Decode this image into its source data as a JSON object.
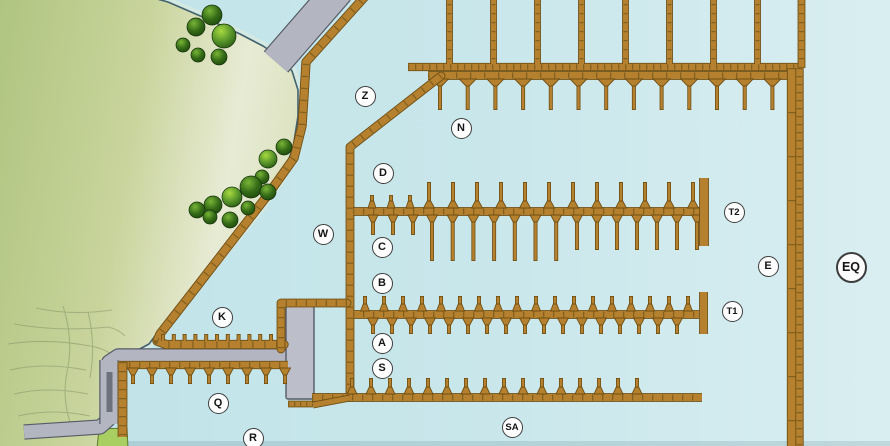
{
  "map_title": "Marina dock map",
  "colors": {
    "water_left": "#bfe3e8",
    "water_mid": "#c9e7eb",
    "water_right": "#d9eef1",
    "water_bottom_shade": "rgba(70,115,125,0.18)",
    "land_deep": "#aec47f",
    "land_mid": "#c9d49c",
    "land_pale": "#e8ebd4",
    "land_shore": "#dde3c2",
    "land_edge": "#41626e",
    "shallow_halo": "#d5e9e3",
    "sketch_line": "#7f9163",
    "lawn_fill": "#a9cf63",
    "lawn_edge": "#5c7a2e",
    "dock_fill": "#b5812f",
    "dock_edge": "#6f4e13",
    "dock_tick": "#7c5c1c",
    "road_fill": "#b3b6c1",
    "road_edge": "#565b66",
    "platform_fill": "#bcbfca",
    "ramp_dark": "#6d717c",
    "tree_hi": "#79b437",
    "tree_mid": "#356b17",
    "tree_dark": "#1c460c",
    "tree_bright_hi": "#a8d93f",
    "tree_bright_mid": "#57942a",
    "tree_bright_dark": "#245410",
    "label_bg": "#fdfdfd",
    "label_border": "#3d3d3d",
    "label_text": "#151515"
  },
  "labels": [
    {
      "id": "Z",
      "x": 365,
      "y": 96
    },
    {
      "id": "N",
      "x": 461,
      "y": 128
    },
    {
      "id": "D",
      "x": 383,
      "y": 173
    },
    {
      "id": "T2",
      "x": 734,
      "y": 212
    },
    {
      "id": "W",
      "x": 323,
      "y": 234
    },
    {
      "id": "C",
      "x": 382,
      "y": 247
    },
    {
      "id": "E",
      "x": 768,
      "y": 266
    },
    {
      "id": "EQ",
      "x": 851,
      "y": 267,
      "big": true
    },
    {
      "id": "B",
      "x": 382,
      "y": 283
    },
    {
      "id": "T1",
      "x": 732,
      "y": 311
    },
    {
      "id": "K",
      "x": 222,
      "y": 317
    },
    {
      "id": "A",
      "x": 382,
      "y": 343
    },
    {
      "id": "S",
      "x": 382,
      "y": 368
    },
    {
      "id": "Q",
      "x": 218,
      "y": 403
    },
    {
      "id": "SA",
      "x": 512,
      "y": 427
    },
    {
      "id": "R",
      "x": 253,
      "y": 438
    }
  ],
  "land": {
    "outline": [
      [
        -8,
        -8
      ],
      [
        132,
        -8
      ],
      [
        168,
        2
      ],
      [
        205,
        18
      ],
      [
        240,
        34
      ],
      [
        263,
        46
      ],
      [
        281,
        58
      ],
      [
        292,
        71
      ],
      [
        298,
        90
      ],
      [
        298,
        116
      ],
      [
        293,
        148
      ],
      [
        281,
        179
      ],
      [
        262,
        206
      ],
      [
        238,
        236
      ],
      [
        208,
        272
      ],
      [
        180,
        306
      ],
      [
        158,
        332
      ],
      [
        149,
        344
      ],
      [
        136,
        351
      ],
      [
        119,
        356
      ],
      [
        112,
        363
      ],
      [
        110,
        400
      ],
      [
        107,
        420
      ],
      [
        100,
        428
      ],
      [
        103,
        448
      ],
      [
        -8,
        448
      ]
    ],
    "sketch_paths": [
      "M36,308 Q72,316 112,310",
      "M14,324 Q58,332 108,327 Q118,329 125,336",
      "M8,344 Q48,338 90,346 Q103,348 111,354",
      "M10,370 Q44,362 86,370",
      "M14,394 Q48,386 88,394",
      "M18,416 Q52,408 90,416",
      "M63,306 Q74,340 67,372 Q62,398 70,422",
      "M88,312 Q96,344 90,378"
    ],
    "lawn": [
      [
        99,
        429
      ],
      [
        127,
        428
      ],
      [
        128,
        448
      ],
      [
        97,
        448
      ]
    ]
  },
  "roads": [
    {
      "name": "access-bridge",
      "path": [
        [
          338.5,
          -10
        ],
        [
          276,
          62
        ]
      ],
      "w": 30
    },
    {
      "name": "shore-road",
      "path": [
        [
          24,
          432
        ],
        [
          100,
          427
        ],
        [
          108,
          420
        ],
        [
          109,
          362
        ],
        [
          118,
          356
        ],
        [
          286,
          356
        ]
      ],
      "w": 13
    },
    {
      "name": "ramp-road",
      "path": [
        [
          109,
          360
        ],
        [
          109,
          424
        ]
      ],
      "w": 17
    }
  ],
  "ramp_rect": {
    "x": 106.5,
    "y": 372,
    "w": 6,
    "h": 40
  },
  "platform": {
    "x": 286,
    "y": 306,
    "w": 28,
    "h": 93
  },
  "docks": [
    {
      "name": "shore-boardwalk",
      "path": [
        [
          369,
          -8
        ],
        [
          306,
          62
        ],
        [
          304,
          96
        ],
        [
          302,
          126
        ],
        [
          294,
          158
        ],
        [
          267,
          196
        ],
        [
          229,
          245
        ],
        [
          195,
          289
        ],
        [
          160,
          334
        ],
        [
          157,
          341
        ],
        [
          166,
          344.5
        ],
        [
          284,
          344.5
        ]
      ],
      "w": 7.5,
      "tick": 12,
      "join": "round",
      "fingers": [
        {
          "dir": -1,
          "x0": 163,
          "dx": 10.8,
          "n": 12,
          "from": 341,
          "len": 7,
          "base": 0
        }
      ]
    },
    {
      "name": "top-walkway",
      "path": [
        [
          408,
          67
        ],
        [
          802,
          67
        ]
      ],
      "w": 6.5,
      "tick": 7
    },
    {
      "name": "mooring-piers",
      "path": [
        [
          449.5,
          -5
        ],
        [
          449.5,
          64
        ]
      ],
      "w": 5,
      "tick": 9,
      "repeat": {
        "dx": 44,
        "n": 8
      }
    },
    {
      "name": "breakwater-pier-top",
      "path": [
        [
          801.5,
          -5
        ],
        [
          801.5,
          68
        ]
      ],
      "w": 6,
      "tick": 9
    },
    {
      "name": "n-dock",
      "path": [
        [
          428,
          75.5
        ],
        [
          793,
          75.5
        ]
      ],
      "w": 7,
      "tick": 14,
      "fingers": [
        {
          "dir": 1,
          "x0": 440,
          "dx": 27.7,
          "n": 13,
          "from": 79,
          "len": 31,
          "base": 17
        }
      ]
    },
    {
      "name": "main-dock",
      "path": [
        [
          441,
          76
        ],
        [
          350,
          147
        ],
        [
          350,
          397
        ]
      ],
      "w": 7,
      "tick": 11,
      "join": "round"
    },
    {
      "name": "cd-dock",
      "path": [
        [
          353,
          211.5
        ],
        [
          700,
          211.5
        ]
      ],
      "w": 7,
      "tick": 10,
      "fingers": [
        {
          "dir": -1,
          "xs": [
            372,
            391,
            410
          ],
          "from": 208,
          "len": 13,
          "base": 8
        },
        {
          "dir": -1,
          "x0": 429,
          "dx": 24,
          "n": 12,
          "from": 208,
          "len": 26,
          "base": 11
        },
        {
          "dir": 1,
          "x0": 373,
          "dx": 20,
          "n": 3,
          "from": 215,
          "len": 20,
          "base": 10
        },
        {
          "dir": 1,
          "x0": 432,
          "dx": 20.7,
          "n": 7,
          "from": 215,
          "len": 46,
          "base": 11
        },
        {
          "dir": 1,
          "x0": 577,
          "dx": 20,
          "n": 7,
          "from": 215,
          "len": 35,
          "base": 11
        }
      ]
    },
    {
      "name": "t2-cap",
      "path": [
        [
          704,
          178
        ],
        [
          704,
          246
        ]
      ],
      "w": 8,
      "tick": 0
    },
    {
      "name": "ab-dock",
      "path": [
        [
          353,
          314.5
        ],
        [
          699,
          314.5
        ]
      ],
      "w": 7,
      "tick": 10,
      "fingers": [
        {
          "dir": -1,
          "x0": 365,
          "dx": 19,
          "n": 18,
          "from": 311,
          "len": 15,
          "base": 9
        },
        {
          "dir": 1,
          "x0": 373,
          "dx": 19,
          "n": 17,
          "from": 318,
          "len": 16,
          "base": 11
        }
      ]
    },
    {
      "name": "t1-cap",
      "path": [
        [
          703.5,
          292
        ],
        [
          703.5,
          334
        ]
      ],
      "w": 7,
      "tick": 0
    },
    {
      "name": "platform-edge-dock",
      "path": [
        [
          347,
          303
        ],
        [
          281,
          303
        ],
        [
          281,
          349
        ]
      ],
      "w": 7,
      "tick": 10,
      "join": "round"
    },
    {
      "name": "s-dock",
      "path": [
        [
          312,
          397.5
        ],
        [
          702,
          397.5
        ]
      ],
      "w": 7,
      "tick": 10,
      "fingers": [
        {
          "dir": -1,
          "x0": 352,
          "dx": 19,
          "n": 16,
          "from": 394,
          "len": 16,
          "base": 10
        }
      ]
    },
    {
      "name": "platform-south-dock",
      "path": [
        [
          288,
          404
        ],
        [
          313,
          404
        ]
      ],
      "w": 5,
      "tick": 6
    },
    {
      "name": "s-dock-stub",
      "path": [
        [
          313,
          405
        ],
        [
          350,
          398
        ]
      ],
      "w": 5,
      "tick": 0
    },
    {
      "name": "q-dock",
      "path": [
        [
          119,
          365
        ],
        [
          288,
          365
        ]
      ],
      "w": 6.5,
      "tick": 10,
      "fingers": [
        {
          "dir": 1,
          "x0": 133,
          "dx": 19,
          "n": 9,
          "from": 368,
          "len": 16,
          "base": 11
        }
      ]
    },
    {
      "name": "q-west-dock",
      "path": [
        [
          122.5,
          362
        ],
        [
          122.5,
          437
        ]
      ],
      "w": 8,
      "tick": 9
    },
    {
      "name": "breakwater-main",
      "path": [
        [
          792,
          68
        ],
        [
          792,
          448
        ]
      ],
      "w": 8.5,
      "tick": 44
    },
    {
      "name": "breakwater-walk",
      "path": [
        [
          799.5,
          68
        ],
        [
          799.5,
          448
        ]
      ],
      "w": 6.5,
      "tick": 8
    }
  ],
  "trees": [
    {
      "x": 183,
      "y": 45,
      "r": 7,
      "b": 0
    },
    {
      "x": 196,
      "y": 27,
      "r": 9,
      "b": 0
    },
    {
      "x": 212,
      "y": 15,
      "r": 10,
      "b": 0
    },
    {
      "x": 224,
      "y": 36,
      "r": 12,
      "b": 1
    },
    {
      "x": 198,
      "y": 55,
      "r": 7,
      "b": 0
    },
    {
      "x": 219,
      "y": 57,
      "r": 8,
      "b": 0
    },
    {
      "x": 284,
      "y": 147,
      "r": 8,
      "b": 0
    },
    {
      "x": 268,
      "y": 159,
      "r": 9,
      "b": 1
    },
    {
      "x": 262,
      "y": 177,
      "r": 7,
      "b": 0
    },
    {
      "x": 251,
      "y": 187,
      "r": 11,
      "b": 0
    },
    {
      "x": 268,
      "y": 192,
      "r": 8,
      "b": 0
    },
    {
      "x": 232,
      "y": 197,
      "r": 10,
      "b": 1
    },
    {
      "x": 213,
      "y": 205,
      "r": 9,
      "b": 0
    },
    {
      "x": 197,
      "y": 210,
      "r": 8,
      "b": 0
    },
    {
      "x": 210,
      "y": 217,
      "r": 7,
      "b": 0
    },
    {
      "x": 230,
      "y": 220,
      "r": 8,
      "b": 0
    },
    {
      "x": 248,
      "y": 208,
      "r": 7,
      "b": 0
    }
  ]
}
